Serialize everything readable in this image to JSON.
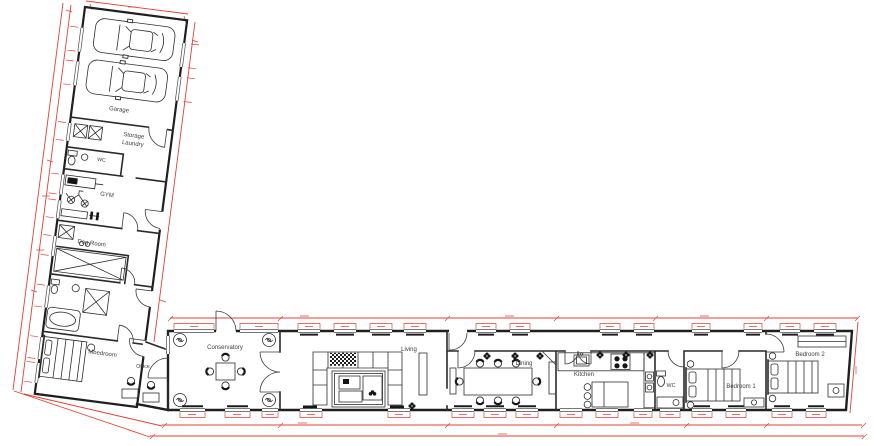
{
  "plan": {
    "colors": {
      "wall": "#1f1f1f",
      "dimension_red": "#e04036"
    },
    "icons": [
      "car-icon",
      "washing-machine-icon",
      "toilet-icon",
      "basin-icon",
      "bath-icon",
      "shower-icon",
      "bed-icon",
      "sofa-icon",
      "rug-icon",
      "coffee-table-icon",
      "dining-table-icon",
      "chair-icon",
      "plant-icon",
      "hob-icon",
      "sink-icon",
      "oven-icon",
      "island-icon",
      "stool-icon",
      "radiator-icon",
      "vent-icon",
      "wardrobe-icon",
      "bench-icon",
      "treadmill-icon",
      "exercise-bike-icon",
      "gym-bench-icon",
      "dog-crate-icon",
      "door-swing-icon",
      "window-icon"
    ],
    "rooms": {
      "garage": "Garage",
      "storage_line1": "Storage",
      "storage_line2": "Laundry",
      "wc_left": "WC",
      "gym": "GYM",
      "dog_room": "Dog Room",
      "master_bedroom": "Mbedroom",
      "office": "Office",
      "conservatory": "Conservatory",
      "living": "Living",
      "dining": "Dining",
      "kitchen": "Kitchen",
      "wc_main": "WC",
      "bedroom_1": "Bedroom 1",
      "bedroom_2": "Bedroom 2"
    }
  }
}
